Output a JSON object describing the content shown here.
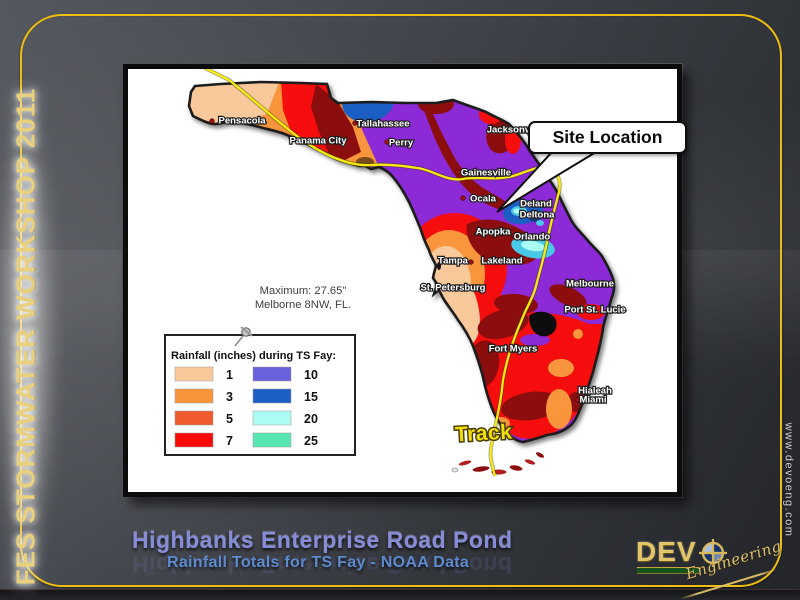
{
  "slide": {
    "banner_left": "FES STORMWATER WORKSHOP 2011",
    "url_right": "www.devoeng.com",
    "title": "Highbanks Enterprise Road Pond",
    "subtitle": "Rainfall Totals for TS Fay - NOAA Data",
    "logo": {
      "wordmark": "DEV",
      "script": "Engineering"
    },
    "colors": {
      "frame_gold": "#edbd12",
      "title_blue": "#868cd8",
      "subtitle_blue": "#5d8bce",
      "banner_gold": "#e9d07c"
    }
  },
  "map": {
    "callout_label": "Site Location",
    "track_label": "Track",
    "max_note_line1": "Maximum: 27.65\"",
    "max_note_line2": "Melborne 8NW, FL.",
    "track_color": "#f7ea0f",
    "legend": {
      "title": "Rainfall (inches) during TS Fay:",
      "entries": [
        {
          "value": "1",
          "color": "#F9C99B"
        },
        {
          "value": "3",
          "color": "#F8953C"
        },
        {
          "value": "5",
          "color": "#EF5B2E"
        },
        {
          "value": "7",
          "color": "#F60B0B"
        },
        {
          "value": "10",
          "color": "#6A62DD"
        },
        {
          "value": "15",
          "color": "#1B5FC4"
        },
        {
          "value": "20",
          "color": "#A9FDF2"
        },
        {
          "value": "25",
          "color": "#57E6B2"
        }
      ]
    },
    "cities": [
      {
        "name": "Pensacola",
        "x": 111,
        "y": 48,
        "dot_x": 81,
        "dot_y": 49
      },
      {
        "name": "Panama City",
        "x": 187,
        "y": 68,
        "dot_x": 160,
        "dot_y": 66
      },
      {
        "name": "Tallahassee",
        "x": 252,
        "y": 51,
        "dot_x": 224,
        "dot_y": 51
      },
      {
        "name": "Perry",
        "x": 270,
        "y": 70,
        "dot_x": 256,
        "dot_y": 70
      },
      {
        "name": "Jacksonville",
        "x": 384,
        "y": 57,
        "dot_x": 360,
        "dot_y": 57,
        "dot_color": "#2563c9"
      },
      {
        "name": "Gainesville",
        "x": 355,
        "y": 100,
        "dot_x": 327,
        "dot_y": 100
      },
      {
        "name": "Ocala",
        "x": 352,
        "y": 126,
        "dot_x": 332,
        "dot_y": 126
      },
      {
        "name": "Deland",
        "x": 405,
        "y": 131,
        "dot_x": 391,
        "dot_y": 131
      },
      {
        "name": "Deltona",
        "x": 406,
        "y": 142,
        "dot_x": 392,
        "dot_y": 142
      },
      {
        "name": "Apopka",
        "x": 362,
        "y": 159,
        "dot_x": 381,
        "dot_y": 160
      },
      {
        "name": "Orlando",
        "x": 401,
        "y": 164,
        "dot_x": 383,
        "dot_y": 164
      },
      {
        "name": "Tampa",
        "x": 322,
        "y": 188,
        "dot_x": 340,
        "dot_y": 190
      },
      {
        "name": "Lakeland",
        "x": 371,
        "y": 188,
        "dot_x": 352,
        "dot_y": 189
      },
      {
        "name": "St. Petersburg",
        "x": 322,
        "y": 215,
        "dot_x": 296,
        "dot_y": 216
      },
      {
        "name": "Melbourne",
        "x": 459,
        "y": 211,
        "dot_x": 436,
        "dot_y": 211
      },
      {
        "name": "Port St. Lucie",
        "x": 464,
        "y": 237,
        "dot_x": 438,
        "dot_y": 237
      },
      {
        "name": "Fort Myers",
        "x": 382,
        "y": 276,
        "dot_x": 361,
        "dot_y": 277
      },
      {
        "name": "Hialeah",
        "x": 464,
        "y": 318,
        "dot_x": 449,
        "dot_y": 319
      },
      {
        "name": "Miami",
        "x": 462,
        "y": 327,
        "dot_x": 447,
        "dot_y": 328
      }
    ]
  }
}
